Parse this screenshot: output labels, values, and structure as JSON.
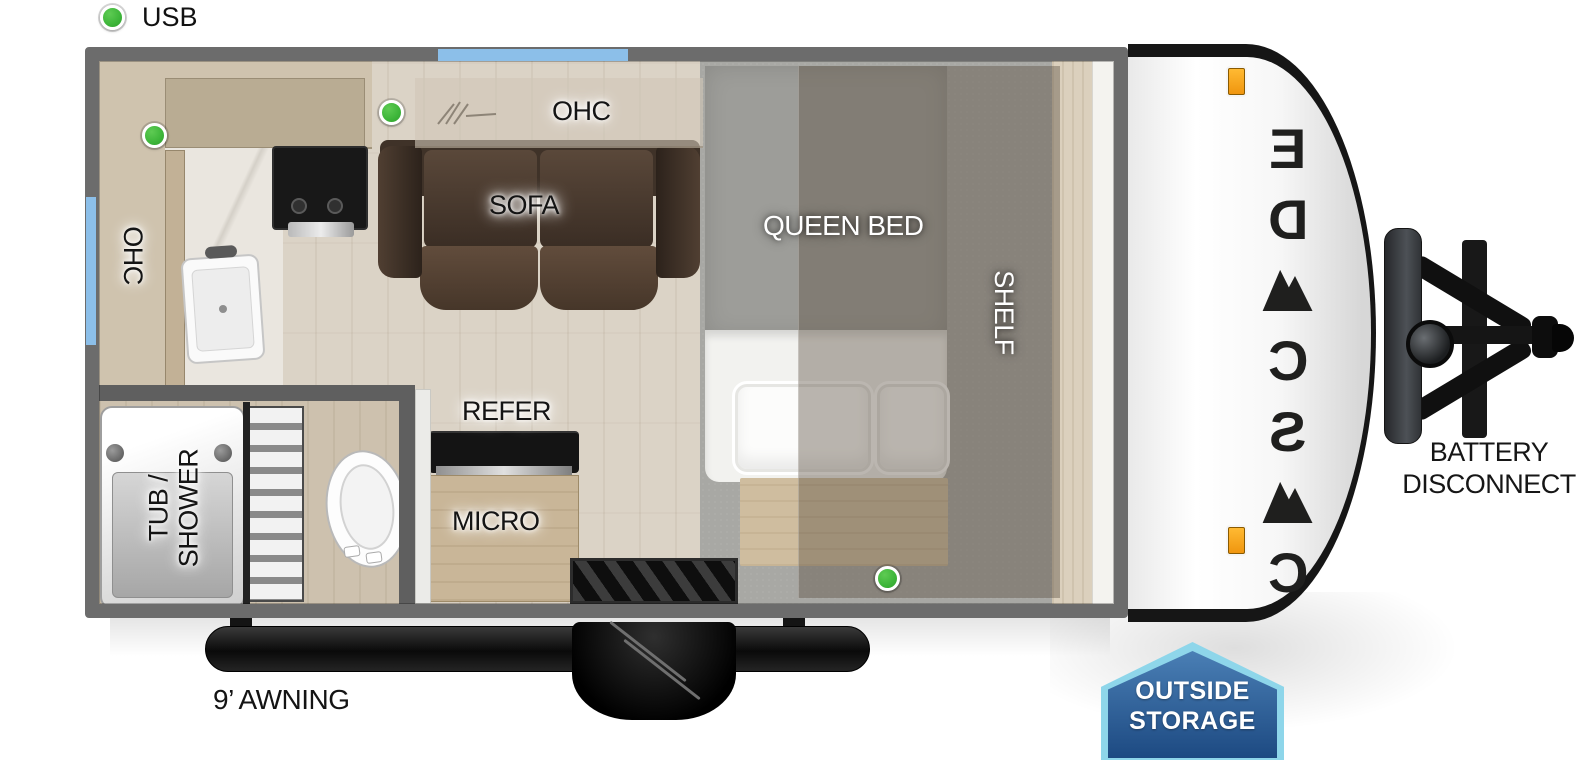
{
  "legend": {
    "usb": "USB"
  },
  "floorplan": {
    "labels": {
      "ohc_left": "OHC",
      "ohc_sofa": "OHC",
      "sofa": "SOFA",
      "queen_bed": "QUEEN BED",
      "shelf": "SHELF",
      "refer": "REFER",
      "micro": "MICRO",
      "tub_line1": "TUB /",
      "tub_line2": "SHOWER"
    },
    "usb_ports": [
      {
        "location": "kitchen",
        "x": 142,
        "y": 123
      },
      {
        "location": "sofa",
        "x": 379,
        "y": 100
      },
      {
        "location": "bedside",
        "x": 875,
        "y": 566
      }
    ]
  },
  "exterior": {
    "brand": {
      "name": "CASCADE"
    },
    "battery": {
      "line1": "BATTERY",
      "line2": "DISCONNECT"
    },
    "awning_label": "9’ AWNING",
    "outside_storage": {
      "line1": "OUTSIDE",
      "line2": "STORAGE"
    }
  },
  "colors": {
    "usb_green": "#3db539",
    "window_blue": "#8cbfe9",
    "wall_gray": "#6c6c6c",
    "badge_border": "#8ed6ea",
    "badge_top": "#4a7fb5",
    "badge_bottom": "#1d4a82",
    "brand_color": "#1f1f1e",
    "marker_orange": "#f0960f"
  }
}
